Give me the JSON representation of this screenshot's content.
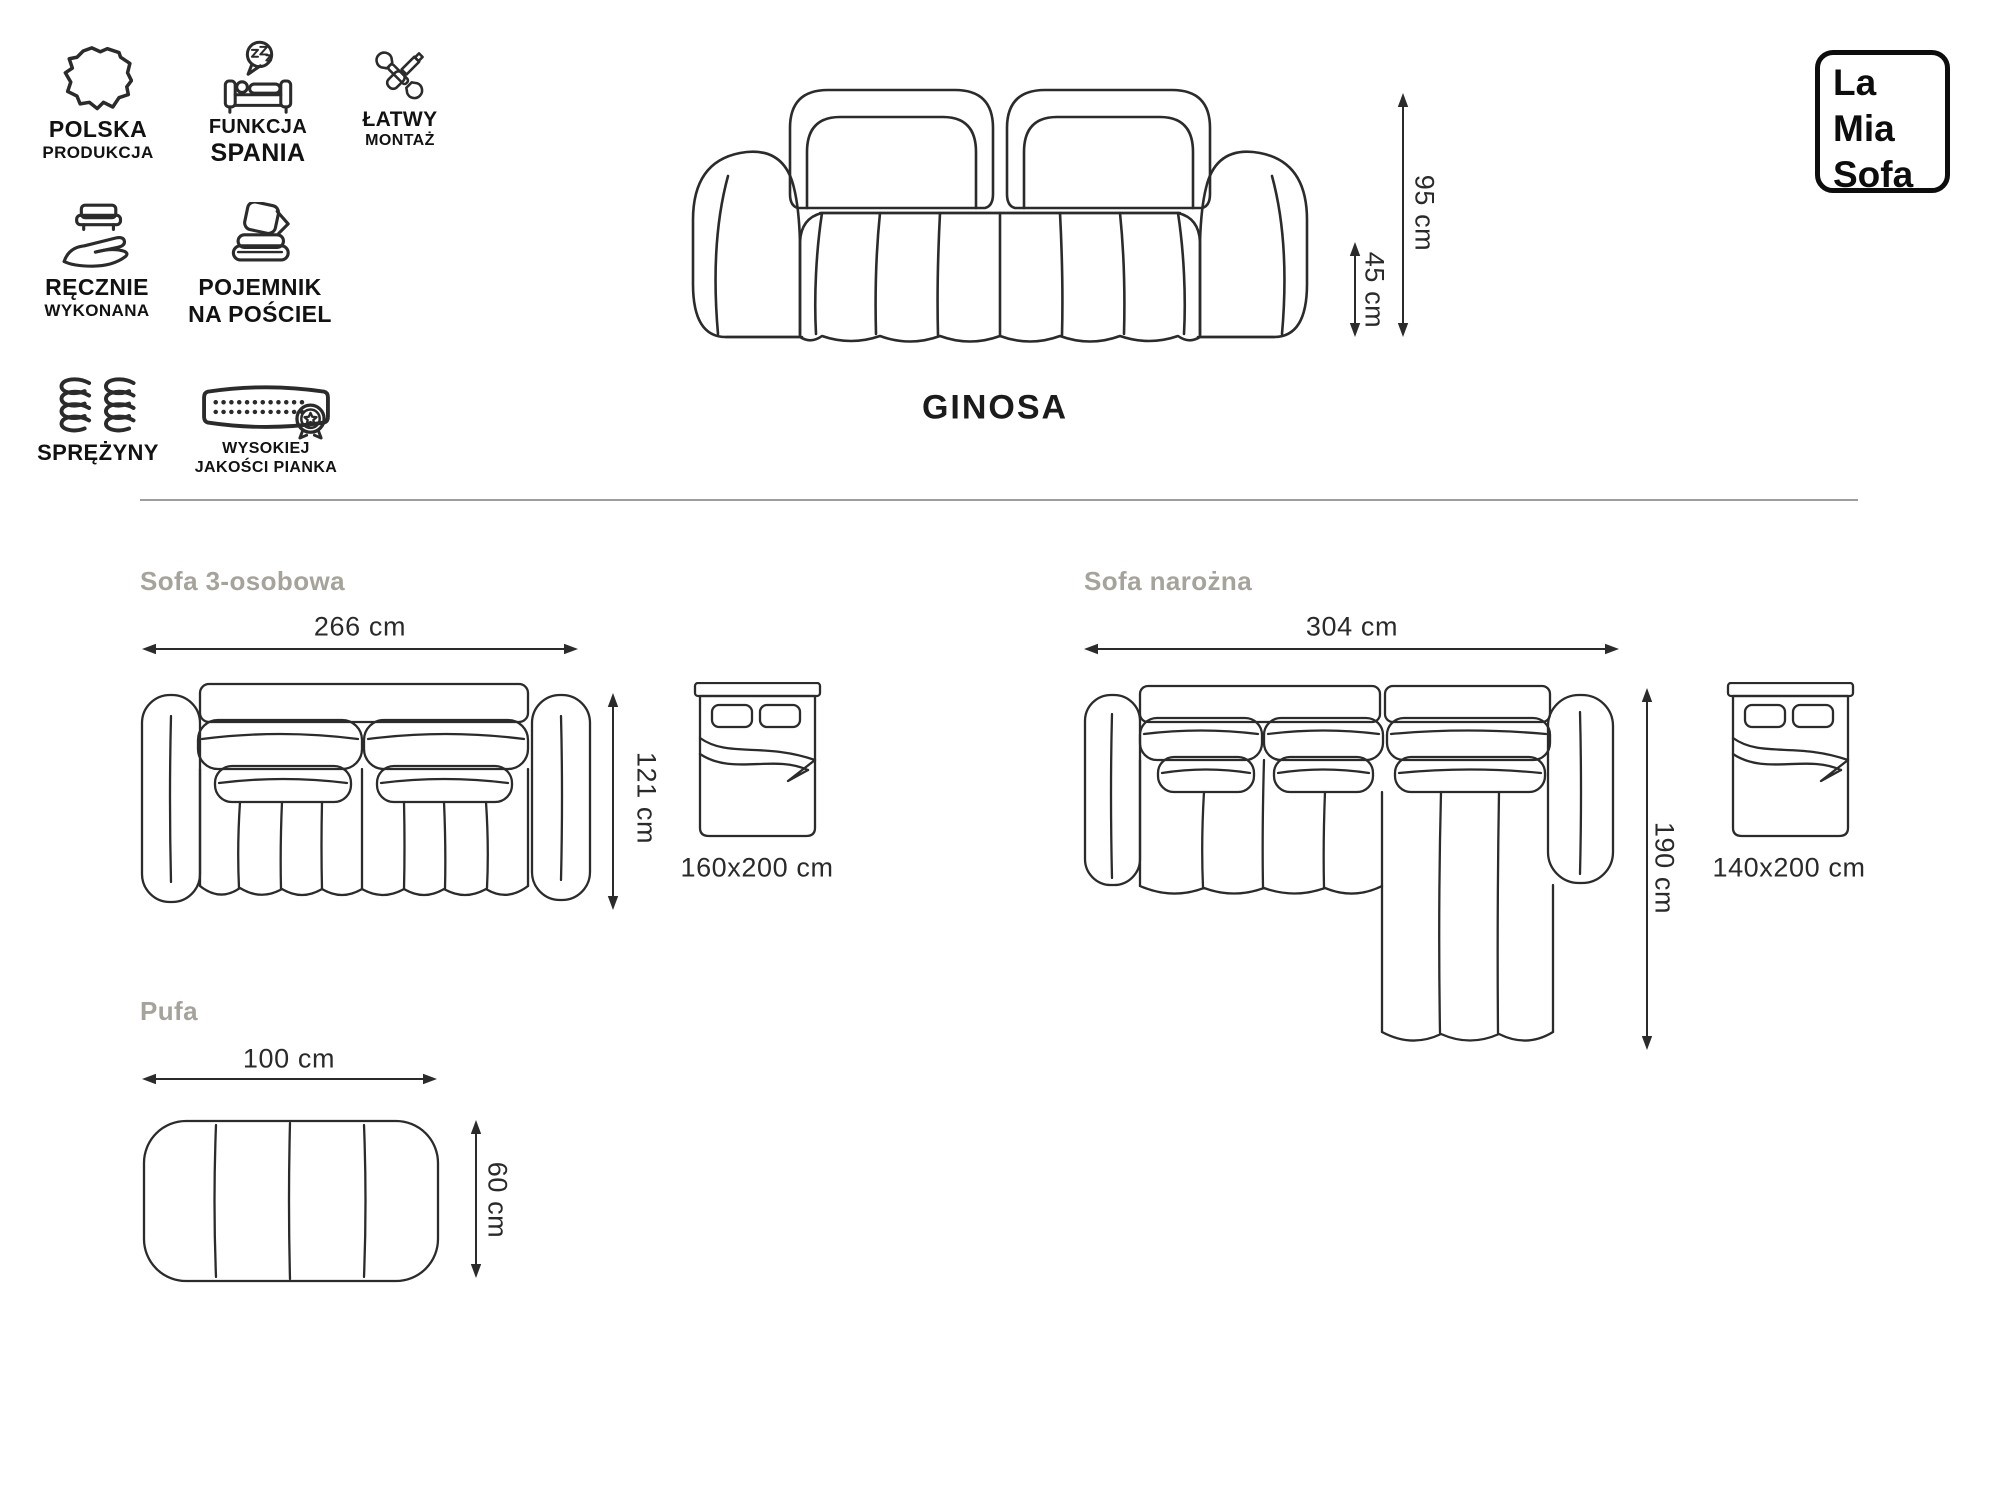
{
  "product": {
    "name": "GINOSA"
  },
  "logo": {
    "lines": [
      "La",
      "Mia",
      "Sofa"
    ]
  },
  "badges": {
    "items": [
      {
        "id": "polska-produkcja",
        "line1": "POLSKA",
        "line2": "PRODUKCJA"
      },
      {
        "id": "funkcja-spania",
        "line1": "FUNKCJA",
        "line2": "SPANIA"
      },
      {
        "id": "latwy-montaz",
        "line1": "ŁATWY",
        "line2": "MONTAŻ"
      },
      {
        "id": "recznie-wykonana",
        "line1": "RĘCZNIE",
        "line2": "WYKONANA"
      },
      {
        "id": "pojemnik-na-posciel",
        "line1": "POJEMNIK",
        "line2": "NA POŚCIEL"
      },
      {
        "id": "sprezyny",
        "line1": "SPRĘŻYNY",
        "line2": ""
      },
      {
        "id": "wysokiej-jakosci-pianka",
        "line1": "WYSOKIEJ",
        "line2": "JAKOŚCI PIANKA"
      }
    ]
  },
  "front_view": {
    "height": "95 cm",
    "seat_height": "45 cm"
  },
  "sections": {
    "sofa3": {
      "title": "Sofa 3-osobowa",
      "width": "266 cm",
      "depth": "121 cm",
      "bed_size": "160x200 cm"
    },
    "corner": {
      "title": "Sofa narożna",
      "width": "304 cm",
      "depth": "190 cm",
      "bed_size": "140x200 cm"
    },
    "pufa": {
      "title": "Pufa",
      "width": "100 cm",
      "depth": "60 cm"
    }
  },
  "colors": {
    "line": "#2b2b2b",
    "icon": "#111111",
    "muted_title": "#a6a39b",
    "divider": "#9e9e9e",
    "text": "#1f1f1f",
    "background": "#ffffff"
  }
}
